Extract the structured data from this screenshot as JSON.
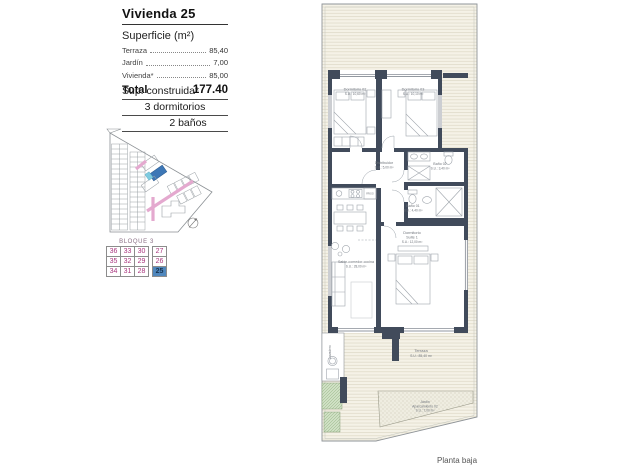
{
  "header": {
    "title": "Vivienda 25",
    "surface_heading": "Superficie (m²)",
    "rows": [
      {
        "label": "Terraza",
        "value": "85,40"
      },
      {
        "label": "Jardín",
        "value": "7,00"
      },
      {
        "label": "Vivienda*",
        "value": "85,00"
      }
    ],
    "total_label": "Total",
    "total_value": "177.40"
  },
  "built": {
    "line1": "Sup. construida*",
    "line2": "3 dormitorios",
    "line3": "2 baños"
  },
  "bloque": {
    "title": "BLOQUE 3",
    "rows": [
      [
        "36",
        "33",
        "30",
        "27"
      ],
      [
        "35",
        "32",
        "29",
        "26"
      ],
      [
        "34",
        "31",
        "28",
        "25"
      ]
    ],
    "highlighted": "25"
  },
  "plan": {
    "rooms": {
      "dorm02": {
        "name": "Dormitorio 02",
        "area": "S.U.: 10,60 m²"
      },
      "dorm03": {
        "name": "Dormitorio 03",
        "area": "S.U.: 10,10 m²"
      },
      "distribuidor": {
        "name": "Distribuidor",
        "area": "S.U.: 5,00 m²"
      },
      "bano02": {
        "name": "Baño 02",
        "area": "S.U.: 3,40 m²"
      },
      "bano01": {
        "name": "Baño 01",
        "area": "S.U.: 4,40 m²"
      },
      "suite": {
        "name": "Dormitorio",
        "name2": "Suite 1",
        "area": "S.U.: 12,00 m²"
      },
      "salon": {
        "name": "Salón-comedor-cocina",
        "area": "S.U.: 28,00 m²"
      },
      "terraza": {
        "name": "Terraza",
        "area": "S.U.: 85,40 m²"
      },
      "jardin": {
        "name": "Jardín",
        "line2": "Aparcamiento 02",
        "area": "S.U.: 7,00 m²"
      },
      "lavadero": {
        "name": "Lavadero"
      },
      "frigo": "FRIGO"
    }
  },
  "footer": {
    "caption": "Planta baja"
  },
  "colors": {
    "wall": "#414b5b",
    "highlight": "#4f87bd",
    "lot_blue": "#3d77b6",
    "street_pink": "#e4a9cf"
  }
}
